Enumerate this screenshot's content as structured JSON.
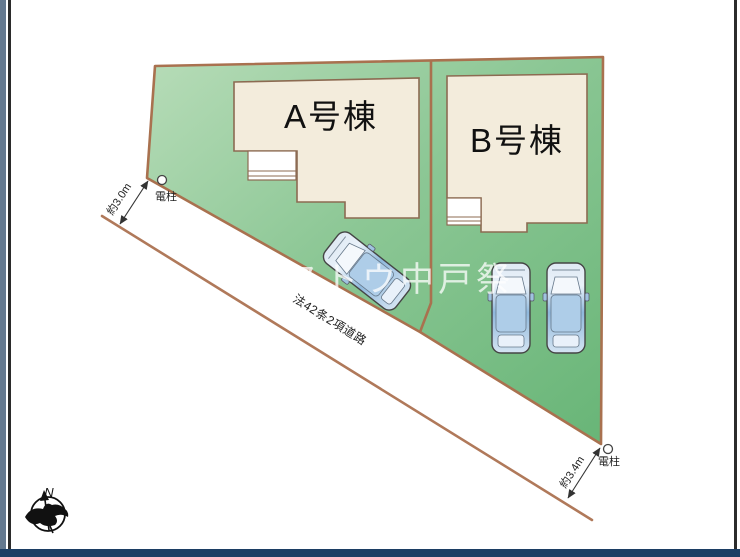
{
  "plan": {
    "title_context": "site-plan-diagram",
    "parcels": [
      {
        "building_label": "A号棟"
      },
      {
        "building_label": "B号棟"
      }
    ],
    "road": {
      "label": "法42条2項道路"
    },
    "dimensions": {
      "left": "約3.0m",
      "right": "約3.4m"
    },
    "utility_poles": {
      "left_label": "電柱",
      "right_label": "電柱"
    },
    "compass": {
      "north_label": "N"
    },
    "watermark": "ストウ中戸祭",
    "icons": [
      "compass-icon",
      "utility-pole-icon",
      "car-icon",
      "dimension-arrow-icon"
    ]
  },
  "colors": {
    "green_light": "#b2d9b4",
    "green_dark": "#6eb87c",
    "boundary_brown": "#a9714f",
    "road_edge_brown": "#b0795a",
    "building_fill": "#f3ecdc",
    "building_stroke": "#8c6b52",
    "car_body_blue": "#a8c9e4",
    "frame_black": "#2b2b2b",
    "side_strip_blue": "#64798f",
    "bottom_bar_navy": "#1c3e64",
    "watermark_white": "#ffffff"
  }
}
